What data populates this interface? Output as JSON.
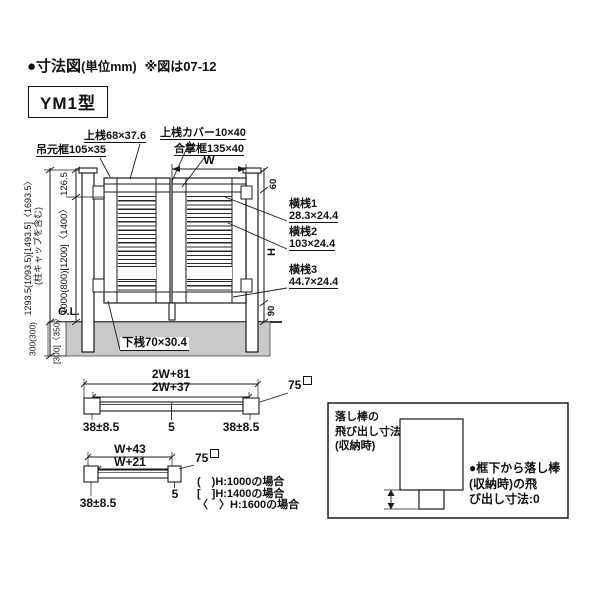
{
  "header": {
    "bullet": "●寸法図",
    "unit": "(単位mm)",
    "note": "※図は07-12",
    "model": "YM1型"
  },
  "colors": {
    "line": "#1a1a1a",
    "foundation": "#c9c9c9"
  },
  "elev": {
    "top_rail": "上桟68×37.6",
    "top_rail_cover": "上桟カバー10×40",
    "hanging_stile": "吊元框105×35",
    "meeting_stile": "合掌框135×40",
    "bottom_rail": "下桟70×30.4",
    "rail1_name": "横桟1",
    "rail1_size": "28.3×24.4",
    "rail2_name": "横桟2",
    "rail2_size": "103×24.4",
    "rail3_name": "横桟3",
    "rail3_size": "44.7×24.4",
    "w": "W",
    "h": "H",
    "top_offset": "60",
    "bottom_clearance": "90",
    "overall_height": "1293.5(1093.5)[1493.5]〈1693.5〉",
    "overall_note": "(柱キャップを含む)",
    "cap_offset": "126.5",
    "post_height": "1000(800)[1200]〈1400〉",
    "gl": "G.L.",
    "depth_main": "300(300)",
    "depth_bracket": "[300]〈350〉"
  },
  "plan2": {
    "outer": "2W+81",
    "inner": "2W+37",
    "post": "75",
    "left": "38±8.5",
    "gap": "5",
    "right": "38±8.5"
  },
  "plan1": {
    "outer": "W+43",
    "inner": "W+21",
    "post": "75",
    "left": "38±8.5",
    "gap": "5"
  },
  "legend": [
    "(　)H:1000の場合",
    "[　]H:1400の場合",
    "〈　〉H:1600の場合"
  ],
  "box": {
    "left": [
      "落し棒の",
      "飛び出し寸法",
      "(収納時)"
    ],
    "right": [
      "●框下から落し棒",
      "(収納時)の飛",
      "び出し寸法:0"
    ]
  }
}
